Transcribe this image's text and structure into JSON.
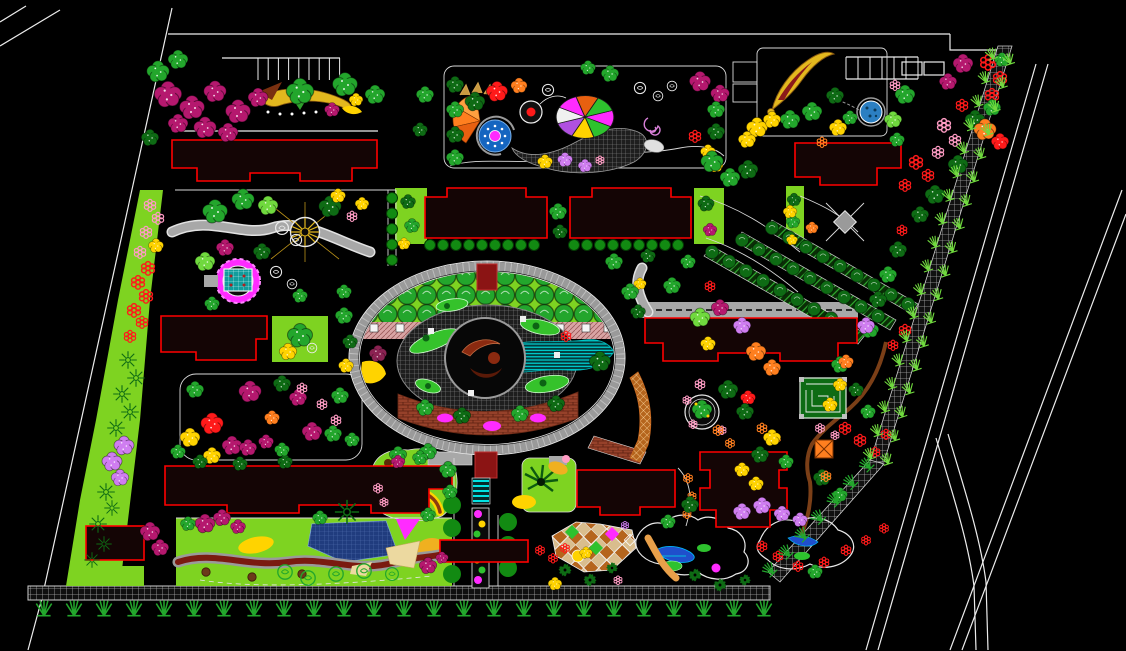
{
  "canvas": {
    "width_px": 1126,
    "height_px": 651,
    "background": "#000000"
  },
  "drawing": {
    "type": "cad-landscape-site-plan",
    "visible_text": [],
    "features": [
      "site-boundary-roads",
      "perimeter-wall-hatched",
      "perimeter-grass-tufts",
      "parking-stall-rows",
      "residential-buildings-red-outline",
      "central-oval-plaza",
      "plaza-tree-lawn-band",
      "plaza-pink-paving-band",
      "plaza-hatched-court",
      "plaza-center-sculpture-pool",
      "plaza-brick-band",
      "plaza-cyan-water-band",
      "gazebo-with-radial-spokes",
      "magenta-circle-pavilion",
      "fan-fountain-garden",
      "mosaic-parterre",
      "spiral-motif",
      "dragon-ribbon-garden",
      "round-pond",
      "tree-lined-parking-lanes",
      "diamond-paving-node",
      "maze-pavilion",
      "circle-tree-plaza",
      "orange-hatched-path",
      "brown-winding-path",
      "stream-rock-garden",
      "blue-pool",
      "palm-lawn-court",
      "checker-diamond-plaza",
      "rock-pond-garden",
      "entrance-gate",
      "flower-bed-strip",
      "zebra-crosswalk",
      "slide-ribbon-feature",
      "tree-clusters",
      "flower-ring-beds"
    ]
  },
  "counts": {
    "buildings": 11,
    "parking_stalls_top": 8,
    "parking_stalls_northeast": 6,
    "plaza_tree_rows": 3,
    "plaza_trees_per_row": 13,
    "parking_lane_tree_rows": 3,
    "parking_lane_trees_per_row": 9,
    "bottom_wall_tufts": 25,
    "boundary_tuft_columns": 2
  },
  "palette": {
    "background": "#000000",
    "boundary_line": "#ececec",
    "building_outline": "#ff0000",
    "building_fill": "#140505",
    "road_gray": "#a8a8a8",
    "lawn_green": "#7ed321",
    "tree_green": "#23a62c",
    "tree_dark_green": "#0e6b14",
    "tree_light_green": "#70d93e",
    "hedge_green": "#128a12",
    "tree_magenta": "#b5186e",
    "flower_red": "#ff1a1a",
    "flower_pink": "#ff9cc4",
    "flower_violet": "#cf7df0",
    "flower_yellow": "#ffd300",
    "flower_orange": "#ff7f1f",
    "flower_maroon": "#8b2252",
    "water_cyan": "#00dede",
    "water_blue": "#1f4fcc",
    "pond_blue": "#2b7fc2",
    "plaza_magenta": "#ff2bff",
    "pavilion_teal": "#129c9c",
    "paving_brick": "#9c4228",
    "paving_pink": "#d9a4a4",
    "paving_checker": "#b5651d",
    "sand_tan": "#ecd9a0",
    "path_brown": "#7b3f17",
    "entrance_darkred": "#8b1414",
    "accent_gold": "#e3b81e"
  }
}
